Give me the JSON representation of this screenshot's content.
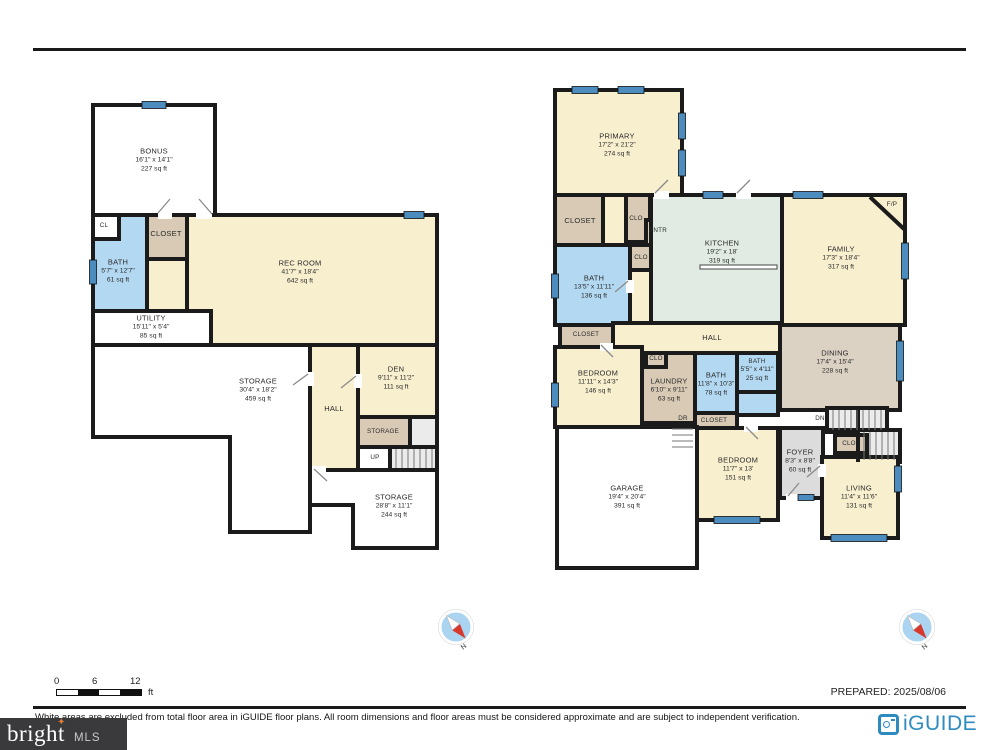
{
  "page": {
    "prepared_label": "PREPARED: 2025/08/06",
    "disclaimer": "White areas are excluded from total floor area in iGUIDE floor plans. All room dimensions and floor areas must be considered approximate and are subject to independent verification."
  },
  "scale_bar": {
    "tick_0": "0",
    "tick_6": "6",
    "tick_12": "12",
    "unit": "ft"
  },
  "branding": {
    "bright": "bright",
    "mls": "MLS",
    "tm": "TM",
    "star": "✦",
    "iguide": "iGUIDE"
  },
  "compass": {
    "north_label": "N"
  },
  "colors": {
    "wall": "#1b1b1b",
    "cream_room": "#f8efce",
    "kitchen_green": "#e1ebe3",
    "bath_blue": "#b3d9f2",
    "closet_tan": "#d8cab4",
    "dining_tan": "#dbd2c3",
    "foyer_gray": "#dcdcdc",
    "stairs_gray": "#ebebeb",
    "window_blue": "#4d8cbe",
    "iguide_blue": "#2e8bc0",
    "bright_star_orange": "#e07b35",
    "compass_red": "#d8372b"
  },
  "plans": [
    {
      "name": "lower-level",
      "rooms": [
        {
          "n": "BONUS",
          "d": "16'1\" x 14'1\"",
          "a": "227 sq ft"
        },
        {
          "n": "CL"
        },
        {
          "n": "BATH",
          "d": "5'7\" x 12'7\"",
          "a": "61 sq ft"
        },
        {
          "n": "CLOSET"
        },
        {
          "n": "REC ROOM",
          "d": "41'7\" x 18'4\"",
          "a": "642 sq ft"
        },
        {
          "n": "UTILITY",
          "d": "15'11\" x 5'4\"",
          "a": "85 sq ft"
        },
        {
          "n": "STORAGE",
          "d": "30'4\" x 18'2\"",
          "a": "459 sq ft"
        },
        {
          "n": "HALL"
        },
        {
          "n": "DEN",
          "d": "9'11\" x 11'2\"",
          "a": "111 sq ft"
        },
        {
          "n": "STORAGE"
        },
        {
          "n": "UP"
        },
        {
          "n": "STORAGE",
          "d": "28'8\" x 11'1\"",
          "a": "244 sq ft"
        }
      ]
    },
    {
      "name": "main-level",
      "rooms": [
        {
          "n": "PRIMARY",
          "d": "17'2\" x 21'2\"",
          "a": "274 sq ft"
        },
        {
          "n": "CLOSET"
        },
        {
          "n": "CLO"
        },
        {
          "n": "PNTR"
        },
        {
          "n": "CLO"
        },
        {
          "n": "BATH",
          "d": "13'5\" x 11'11\"",
          "a": "136 sq ft"
        },
        {
          "n": "KITCHEN",
          "d": "19'2\" x 18'",
          "a": "319 sq ft"
        },
        {
          "n": "FAMILY",
          "d": "17'3\" x 18'4\"",
          "a": "317 sq ft"
        },
        {
          "n": "F/P"
        },
        {
          "n": "HALL"
        },
        {
          "n": "CLOSET"
        },
        {
          "n": "BEDROOM",
          "d": "11'11\" x 14'3\"",
          "a": "146 sq ft"
        },
        {
          "n": "CLO"
        },
        {
          "n": "LAUNDRY",
          "d": "6'10\" x 9'11\"",
          "a": "63 sq ft"
        },
        {
          "n": "BATH",
          "d": "11'8\" x 10'3\"",
          "a": "78 sq ft"
        },
        {
          "n": "BATH",
          "d": "5'5\" x 4'11\"",
          "a": "25 sq ft"
        },
        {
          "n": "DINING",
          "d": "17'4\" x 15'4\"",
          "a": "228 sq ft"
        },
        {
          "n": "DN"
        },
        {
          "n": "CLOSET"
        },
        {
          "n": "DR"
        },
        {
          "n": "CLO"
        },
        {
          "n": "FOYER",
          "d": "8'3\" x 8'8\"",
          "a": "60 sq ft"
        },
        {
          "n": "GARAGE",
          "d": "19'4\" x 20'4\"",
          "a": "391 sq ft"
        },
        {
          "n": "BEDROOM",
          "d": "11'7\" x 13'",
          "a": "151 sq ft"
        },
        {
          "n": "LIVING",
          "d": "11'4\" x 11'6\"",
          "a": "131 sq ft"
        }
      ]
    }
  ]
}
